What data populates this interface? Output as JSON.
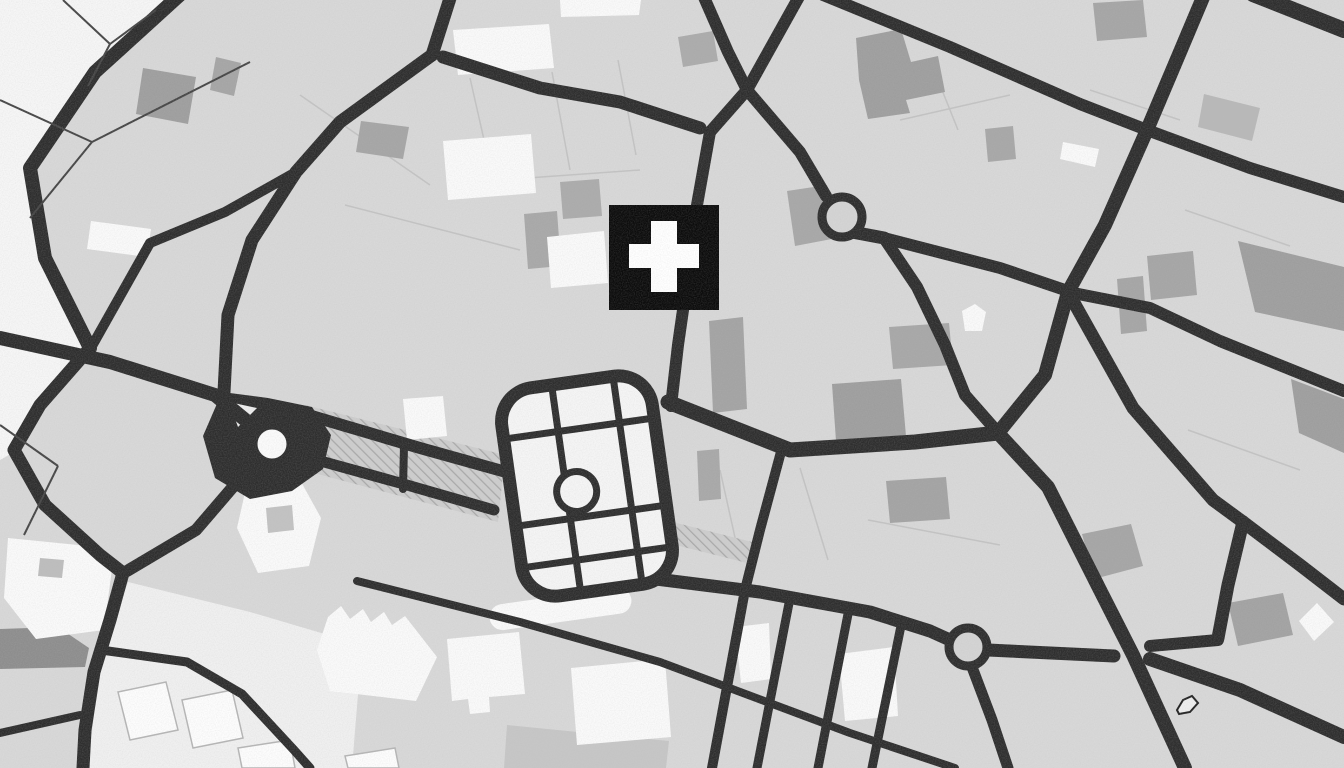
{
  "map": {
    "canvas": {
      "w": 1344,
      "h": 768
    },
    "colors": {
      "background": "#d8d8d8",
      "road": "#2d2d2d",
      "area_white": "#f6f6f6",
      "building_white": "#fafafa",
      "park_fill": "#f5f5f5",
      "marker_black": "#0b0b0b",
      "marker_cross": "#ffffff",
      "hatch_base": "#cdcdcd",
      "hatch_line": "#a8a8a8",
      "parcel_faint": "#c3c3c3",
      "parcel_dark": "#454545",
      "outlined_parcel_fill": "#fdfdfd",
      "outlined_parcel_stroke": "#b5b5b5"
    },
    "areas": [
      {
        "d": "M 0,0 L 178,0 L 92,72 L 30,168 L 44,256 L 88,345 L 40,404 L 14,452 L 0,460 Z",
        "fill": "#f6f6f6"
      },
      {
        "d": "M 128,582 L 250,612 L 362,645 L 352,768 L 88,768 L 100,660 Z",
        "fill": "#f0f0f0"
      }
    ],
    "parcel_lines_faint": [
      "M 300,95 L 430,185",
      "M 345,205 L 520,250",
      "M 470,78 L 492,175",
      "M 552,72 L 570,170",
      "M 618,60 L 636,155",
      "M 500,180 L 640,170",
      "M 900,120 L 1010,95",
      "M 930,60 L 958,130",
      "M 1185,210 L 1290,246",
      "M 720,470 L 740,560",
      "M 800,468 L 828,560",
      "M 868,520 L 1000,545",
      "M 1188,430 L 1300,470",
      "M 1090,90 L 1180,120"
    ],
    "hatches": [
      {
        "d": "M 305,405 L 505,455 L 498,522 L 295,468 Z"
      },
      {
        "d": "M 645,515 L 752,542 L 747,563 L 640,536 Z"
      }
    ],
    "buildings_gray": [
      {
        "d": "M 0,629 L 58,627 L 89,648 L 85,667 L 0,669 Z",
        "fill": "#8d8d8d"
      },
      {
        "d": "M 216,57 L 241,63 L 234,96 L 210,90 Z",
        "fill": "#a5a5a5"
      },
      {
        "d": "M 361,121 L 409,127 L 403,159 L 356,152 Z",
        "fill": "#a5a5a5"
      },
      {
        "d": "M 856,38 L 901,29 L 911,62 L 938,56 L 945,92 L 906,100 L 910,113 L 868,119 L 859,80 Z",
        "fill": "#9e9e9e"
      },
      {
        "d": "M 678,37 L 713,31 L 718,61 L 683,67 Z",
        "fill": "#ababab"
      },
      {
        "d": "M 524,214 L 557,211 L 561,266 L 528,269 Z",
        "fill": "#a8a8a8"
      },
      {
        "d": "M 560,182 L 599,179 L 602,216 L 563,219 Z",
        "fill": "#ababab"
      },
      {
        "d": "M 709,321 L 743,317 L 747,409 L 713,413 Z",
        "fill": "#a3a3a3"
      },
      {
        "d": "M 832,384 L 901,379 L 906,436 L 836,441 Z",
        "fill": "#9e9e9e"
      },
      {
        "d": "M 886,481 L 946,477 L 950,519 L 890,523 Z",
        "fill": "#a3a3a3"
      },
      {
        "d": "M 697,451 L 719,449 L 721,499 L 699,501 Z",
        "fill": "#a8a8a8"
      },
      {
        "d": "M 787,191 L 827,185 L 837,238 L 795,246 Z",
        "fill": "#a7a7a7"
      },
      {
        "d": "M 889,327 L 949,323 L 953,365 L 893,369 Z",
        "fill": "#a7a7a7"
      },
      {
        "d": "M 985,129 L 1013,126 L 1016,159 L 988,162 Z",
        "fill": "#a7a7a7"
      },
      {
        "d": "M 1093,3 L 1143,0 L 1147,37 L 1097,41 Z",
        "fill": "#a5a5a5"
      },
      {
        "d": "M 1238,241 L 1344,267 L 1344,331 L 1255,312 Z",
        "fill": "#9e9e9e"
      },
      {
        "d": "M 1147,256 L 1193,251 L 1197,295 L 1151,300 Z",
        "fill": "#a5a5a5"
      },
      {
        "d": "M 1117,279 L 1143,276 L 1147,331 L 1121,334 Z",
        "fill": "#a5a5a5"
      },
      {
        "d": "M 1228,603 L 1283,593 L 1293,635 L 1238,646 Z",
        "fill": "#a2a2a2"
      },
      {
        "d": "M 1291,379 L 1344,399 L 1344,453 L 1299,433 Z",
        "fill": "#9e9e9e"
      },
      {
        "d": "M 507,725 L 669,741 L 666,768 L 504,768 Z",
        "fill": "#c6c6c6"
      },
      {
        "d": "M 1082,534 L 1131,524 L 1143,566 L 1094,579 Z",
        "fill": "#a5a5a5"
      },
      {
        "d": "M 143,68 L 196,77 L 188,124 L 136,114 Z",
        "fill": "#9e9e9e"
      },
      {
        "d": "M 1204,94 L 1260,108 L 1252,141 L 1198,127 Z",
        "fill": "#b8b8b8"
      }
    ],
    "buildings_white": [
      "M 453,30 L 549,24 L 554,68 L 458,75 Z",
      "M 560,0 L 641,0 L 639,15 L 561,17 Z",
      "M 443,141 L 531,134 L 536,193 L 448,200 Z",
      "M 547,237 L 604,231 L 608,283 L 551,288 Z",
      "M 403,399 L 443,396 L 447,436 L 407,440 Z",
      "M 328,617 L 341,606 L 350,619 L 363,609 L 371,622 L 384,612 L 392,625 L 405,616 L 437,657 L 416,701 L 330,691 L 317,650 Z",
      "M 447,639 L 519,632 L 525,694 L 489,697 L 490,712 L 470,714 L 468,699 L 452,701 Z",
      "M 571,668 L 665,659 L 671,737 L 577,745 Z",
      "M 735,627 L 769,623 L 771,679 L 741,683 Z",
      "M 839,654 L 894,647 L 898,716 L 845,721 Z",
      "M 962,311 L 975,304 L 986,312 L 982,331 L 965,331 Z",
      "M 1299,621 L 1317,603 L 1334,622 L 1314,641 Z",
      "M 246,488 L 299,478 L 321,518 L 309,566 L 258,573 L 237,528 Z",
      "M 8,538 L 98,547 L 113,561 L 104,630 L 36,639 L 4,598 Z",
      "M 91,221 L 151,229 L 147,257 L 87,249 Z",
      "M 1063,142 L 1099,149 L 1095,167 L 1060,159 Z"
    ],
    "courtyards": [
      {
        "d": "M 40,558 L 64,560 L 62,578 L 38,576 Z",
        "fill": "#bdbdbd"
      },
      {
        "d": "M 266,508 L 292,505 L 294,530 L 268,533 Z",
        "fill": "#c2c2c2"
      }
    ],
    "white_pill": {
      "x": 489,
      "y": 596,
      "w": 143,
      "h": 26,
      "rx": 13,
      "rot": -8,
      "cx": 560,
      "cy": 609
    },
    "outlined_parcels": [
      "M 118,692 L 166,682 L 178,730 L 130,740 Z",
      "M 182,700 L 232,690 L 243,738 L 193,748 Z",
      "M 238,748 L 290,740 L 295,768 L 242,768 Z",
      "M 345,756 L 395,748 L 399,768 L 348,768 Z"
    ],
    "junction_blob": "M 222,392 L 268,398 L 312,407 L 331,435 L 323,469 L 292,491 L 250,499 L 215,478 L 203,436 Z",
    "blob_notch": {
      "d": "M 229,402 L 257,408 L 238,427 Z",
      "fill": "#ededed"
    },
    "roads": [
      {
        "d": "M 183,-8 L 95,72 L 30,168 L 45,258 L 90,348",
        "w": 14
      },
      {
        "d": "M 90,348 L 40,405 L 14,450 L 45,505 L 100,555 L 123,573",
        "w": 13
      },
      {
        "d": "M 123,573 L 110,620 L 94,672 L 85,730 L 83,768",
        "w": 13
      },
      {
        "d": "M 0,338 L 110,362 L 215,395 L 255,428",
        "w": 14
      },
      {
        "d": "M 256,460 L 196,530 L 127,571",
        "w": 12
      },
      {
        "d": "M 452,-8 L 432,55",
        "w": 13
      },
      {
        "d": "M 432,55 L 340,122 L 296,172 L 252,240 L 228,315 L 224,392",
        "w": 13
      },
      {
        "d": "M 296,172 L 225,212 L 150,243 L 92,346",
        "w": 10
      },
      {
        "d": "M 443,57 L 540,88 L 620,102 L 700,128",
        "w": 13
      },
      {
        "d": "M 703,-5 L 728,52 L 747,90",
        "w": 12
      },
      {
        "d": "M 800,-5 L 747,90",
        "w": 12
      },
      {
        "d": "M 747,90 L 710,132",
        "w": 12
      },
      {
        "d": "M 747,90 L 800,152 L 826,196",
        "w": 12
      },
      {
        "d": "M 710,132 L 697,205 L 688,275 L 678,345 L 671,406",
        "w": 12
      },
      {
        "d": "M 852,232 L 884,238",
        "w": 13
      },
      {
        "d": "M 884,238 L 1000,268 L 1062,289",
        "w": 12
      },
      {
        "d": "M 884,238 L 917,287 L 945,345 L 965,395 L 994,428",
        "w": 12
      },
      {
        "d": "M 668,402 L 790,450 L 915,442 L 998,433",
        "w": 15
      },
      {
        "d": "M 998,433 L 1048,487 L 1100,590 L 1133,655 L 1185,768",
        "w": 14
      },
      {
        "d": "M 998,433 L 1045,375 L 1068,292",
        "w": 14
      },
      {
        "d": "M 1068,292 L 1105,225 L 1147,130",
        "w": 14
      },
      {
        "d": "M 1147,130 L 1180,52 L 1204,-5",
        "w": 14
      },
      {
        "d": "M 823,-5 L 950,47 L 1080,104 L 1147,130",
        "w": 12
      },
      {
        "d": "M 1147,130 L 1250,168 L 1344,197",
        "w": 12
      },
      {
        "d": "M 1253,-6 L 1344,30",
        "w": 16
      },
      {
        "d": "M 1068,292 L 1150,308 L 1220,341 L 1344,391",
        "w": 12
      },
      {
        "d": "M 1068,292 L 1133,408 L 1213,500 L 1243,522",
        "w": 13
      },
      {
        "d": "M 1243,522 L 1300,565 L 1344,599",
        "w": 13
      },
      {
        "d": "M 1243,522 L 1228,585 L 1218,638",
        "w": 13
      },
      {
        "d": "M 1218,640 L 1150,646",
        "w": 12
      },
      {
        "d": "M 298,412 L 420,448 L 506,472",
        "w": 12
      },
      {
        "d": "M 288,452 L 400,483 L 494,510",
        "w": 11
      },
      {
        "d": "M 404,446 L 403,489",
        "w": 8
      },
      {
        "d": "M 640,577 L 760,592 L 870,612 L 930,631 L 950,640",
        "w": 13
      },
      {
        "d": "M 988,650 L 1114,656",
        "w": 13
      },
      {
        "d": "M 1150,659 L 1240,690 L 1344,737",
        "w": 14
      },
      {
        "d": "M 972,667 L 992,720 L 1008,768",
        "w": 11
      },
      {
        "d": "M 782,448 L 760,530 L 745,590 L 712,768",
        "w": 10
      },
      {
        "d": "M 790,598 L 757,768",
        "w": 9
      },
      {
        "d": "M 849,609 L 818,768",
        "w": 9
      },
      {
        "d": "M 902,621 L 872,768",
        "w": 9
      },
      {
        "d": "M 357,581 L 520,622 L 660,662 L 850,733 L 955,768",
        "w": 8
      },
      {
        "d": "M 101,650 L 187,662 L 242,694 L 294,750 L 310,768",
        "w": 9
      },
      {
        "d": "M 0,733 L 80,715",
        "w": 8
      }
    ],
    "parcel_lines_dark": [
      "M 63,0 L 110,44",
      "M 110,44 L 156,10",
      "M 110,44 L 88,86",
      "M 0,100 L 92,142",
      "M 92,142 L 250,62",
      "M 30,218 L 92,142",
      "M 0,425 L 58,466",
      "M 58,466 L 24,535"
    ],
    "park": {
      "rot": -8,
      "cx": 587,
      "cy": 486,
      "rect": {
        "x": 511,
        "y": 381,
        "w": 152,
        "h": 210,
        "rx": 34
      },
      "border_w": 13,
      "grid_w": 7,
      "fill": "#f5f5f5",
      "v_lines": [
        {
          "x": 566,
          "y1": 387,
          "y2": 585
        },
        {
          "x": 628,
          "y1": 387,
          "y2": 585
        }
      ],
      "h_lines": [
        {
          "y": 428,
          "x1": 517,
          "x2": 657
        },
        {
          "y": 516,
          "x1": 517,
          "x2": 657
        },
        {
          "y": 558,
          "x1": 517,
          "x2": 657
        }
      ],
      "ring": {
        "cx": 576,
        "cy": 490,
        "r": 20
      }
    },
    "roundabouts": [
      {
        "cx": 272,
        "cy": 444,
        "r": 19,
        "ring_w": 9,
        "fill": "#fbfbfb"
      },
      {
        "cx": 842,
        "cy": 217,
        "r": 20,
        "ring_w": 9,
        "fill": "#d4d4d4"
      },
      {
        "cx": 968,
        "cy": 647,
        "r": 19,
        "ring_w": 9,
        "fill": "#d4d4d4"
      }
    ],
    "squiggle": {
      "d": "M 1177,710 L 1183,700 L 1192,696 L 1198,703 L 1190,712 L 1179,714 Z",
      "stroke": "#222222",
      "fill": "#eeeeee"
    },
    "hospital_marker": {
      "x": 609,
      "y": 205,
      "w": 110,
      "h": 105,
      "fill": "#0b0b0b",
      "cross": {
        "vx": 651,
        "vy": 221,
        "vw": 26,
        "vh": 71,
        "hx": 629,
        "hy": 244,
        "hw": 70,
        "hh": 24,
        "fill": "#ffffff"
      }
    },
    "grain": {
      "base_frequency": 0.85,
      "opacity": 0.4
    }
  }
}
